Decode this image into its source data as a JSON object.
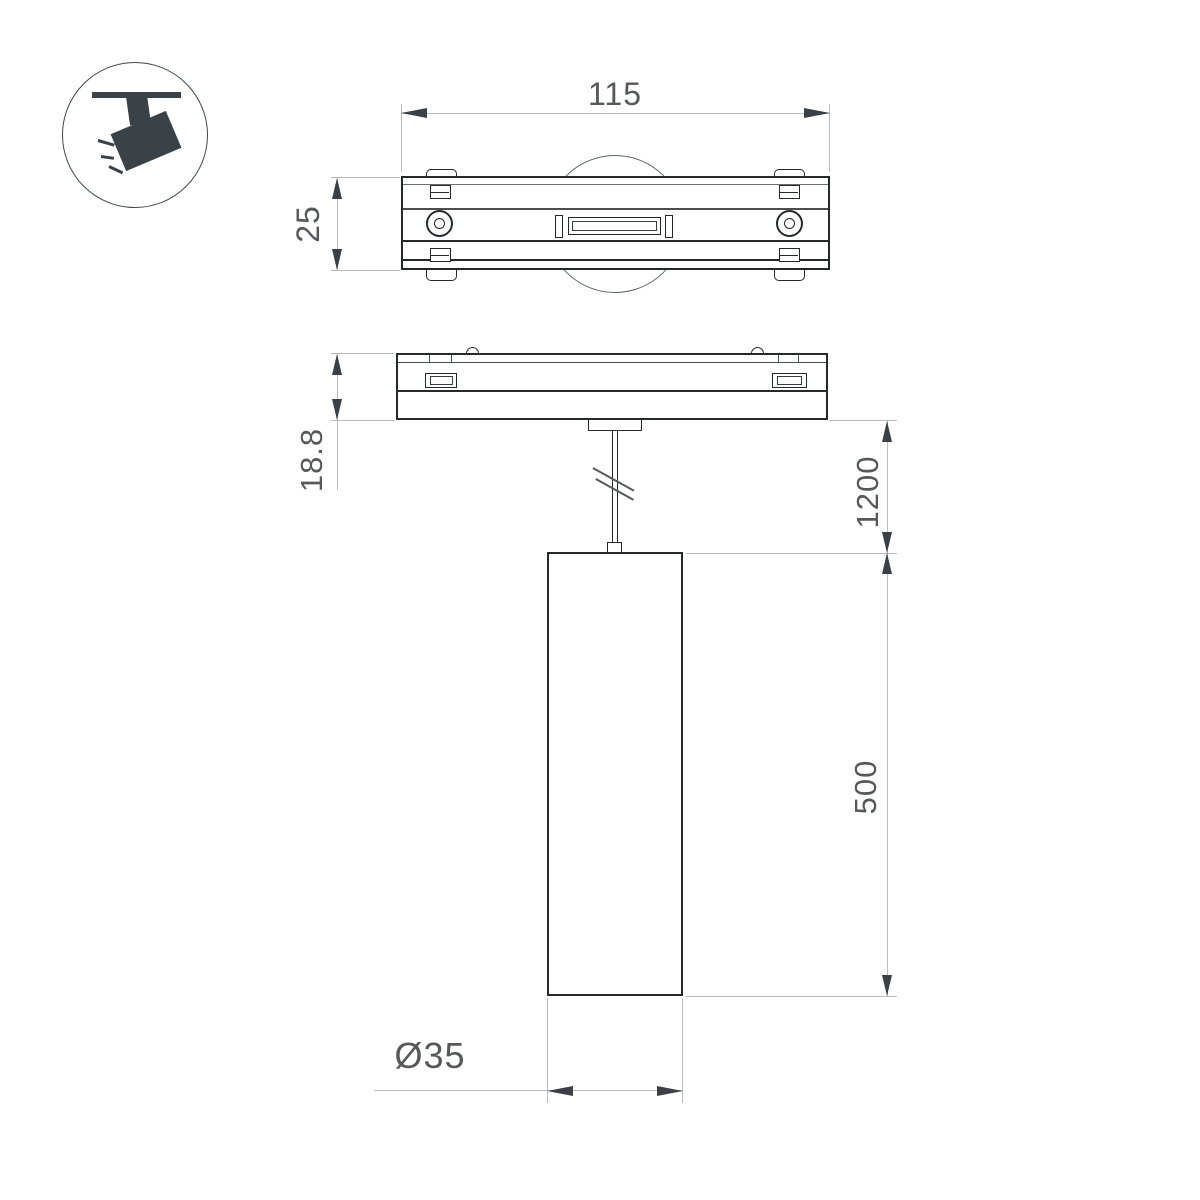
{
  "drawing": {
    "type": "luminaire-dimension-drawing",
    "views": [
      "track-adapter-top-view",
      "track-adapter-side-view",
      "pendant-cylinder-front-view"
    ],
    "icon": "track-spotlight-icon",
    "dimensions": {
      "track_length": "115",
      "track_height": "25",
      "base_thickness": "18.8",
      "suspension_length": "1200",
      "body_length": "500",
      "body_diameter": "Ø35"
    },
    "colors": {
      "object_line": "#26282a",
      "dimension_line": "#b9bdbf",
      "arrow": "#3a4045",
      "text": "#55595c",
      "icon_fill": "#3b4247",
      "background": "#ffffff"
    }
  }
}
